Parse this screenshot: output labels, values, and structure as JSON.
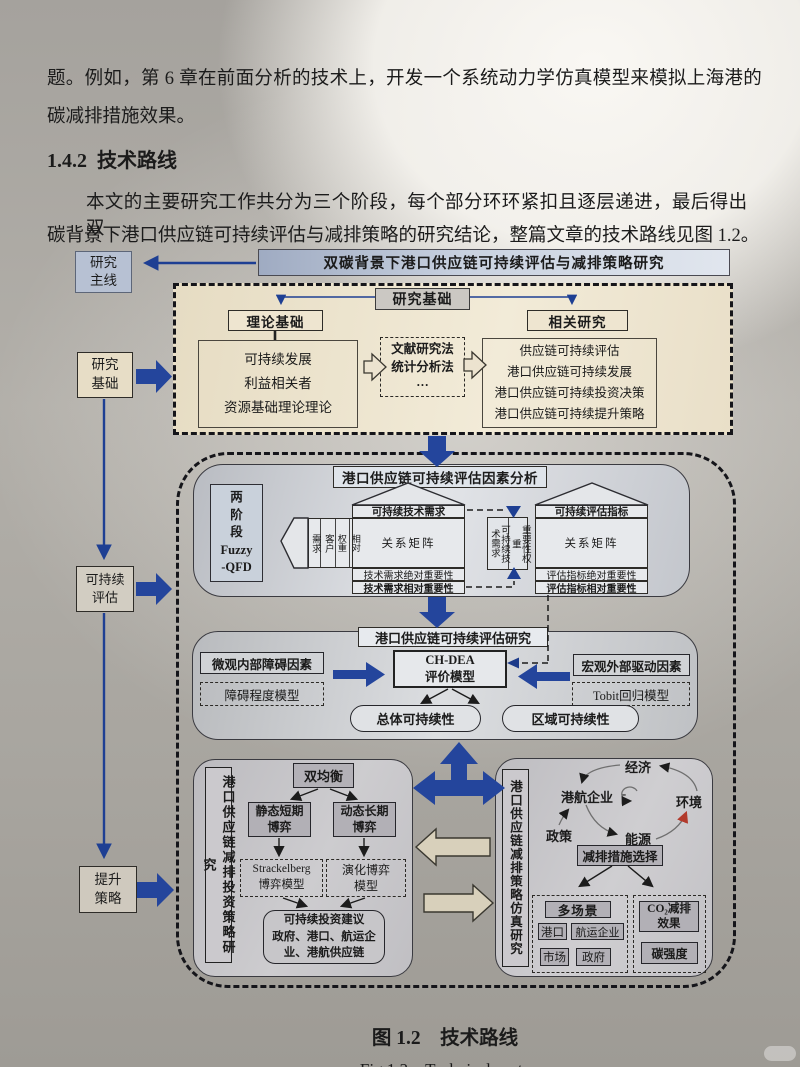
{
  "page": {
    "line1": "题。例如，第 6 章在前面分析的技术上，开发一个系统动力学仿真模型来模拟上海港的",
    "line2": "碳减排措施效果。",
    "heading_no": "1.4.2",
    "heading_title": "技术路线",
    "para1": "本文的主要研究工作共分为三个阶段，每个部分环环紧扣且逐层递进，最后得出双",
    "para2": "碳背景下港口供应链可持续评估与减排策略的研究结论，整篇文章的技术路线见图 1.2。",
    "caption_cn": "图 1.2　技术路线",
    "caption_en": "Fig 1.2　Technical route"
  },
  "sidebar": {
    "main": "研究\n主线",
    "foundation": "研究\n基础",
    "evaluation": "可持续\n评估",
    "strategy": "提升\n策略"
  },
  "top_bar": "双碳背景下港口供应链可持续评估与减排策略研究",
  "foundation": {
    "header": "研究基础",
    "theory_title": "理论基础",
    "theory_items": "可持续发展\n利益相关者\n资源基础理论理论",
    "methods": "文献研究法\n统计分析法\n···",
    "related_title": "相关研究",
    "related_items": "供应链可持续评估\n港口供应链可持续发展\n港口供应链可持续投资决策\n港口供应链可持续提升策略"
  },
  "qfd": {
    "title": "港口供应链可持续评估因素分析",
    "stage": "两\n阶\n段\nFuzzy\n-QFD",
    "house1": {
      "roof": "相关矩阵",
      "pentagon": "相关\n矩阵",
      "cols": [
        "需求",
        "客户",
        "权重",
        "相对"
      ],
      "header": "可持续技术需求",
      "matrix": "关系矩阵",
      "abs": "技术需求绝对重要性",
      "rel": "技术需求相对重要性"
    },
    "bridge": {
      "left": "可持续技术需求",
      "right": "重要性权重"
    },
    "house2": {
      "roof": "相关矩阵",
      "header": "可持续评估指标",
      "matrix": "关系矩阵",
      "abs": "评估指标绝对重要性",
      "rel": "评估指标相对重要性"
    }
  },
  "evaluation": {
    "title": "港口供应链可持续评估研究",
    "micro": "微观内部障碍因素",
    "obstacle": "障碍程度模型",
    "chdea": "CH-DEA\n评价模型",
    "macro": "宏观外部驱动因素",
    "tobit": "Tobit回归模型",
    "overall": "总体可持续性",
    "regional": "区域可持续性"
  },
  "invest": {
    "side": "港口供应链减排投资策略研究",
    "dual": "双均衡",
    "static_game": "静态短期\n博弈",
    "dynamic_game": "动态长期\n博弈",
    "stackelberg": "Strackelberg\n博弈模型",
    "evolution": "演化博弈\n模型",
    "advice": "可持续投资建议\n政府、港口、航运企\n业、港航供应链"
  },
  "layers": {
    "macro": "宏观层面",
    "micro": "微观层面"
  },
  "simulation": {
    "side": "港口供应链减排策略仿真研究",
    "loop": {
      "economy": "经济",
      "enterprise": "港航企业",
      "environment": "环境",
      "policy": "政策",
      "energy": "能源",
      "minus": "-"
    },
    "measure": "减排措施选择",
    "multiscene": "多场景",
    "port": "港口",
    "shipping": "航运企业",
    "market": "市场",
    "government": "政府",
    "co2": "CO₂减排\n效果",
    "carbon": "碳强度"
  }
}
